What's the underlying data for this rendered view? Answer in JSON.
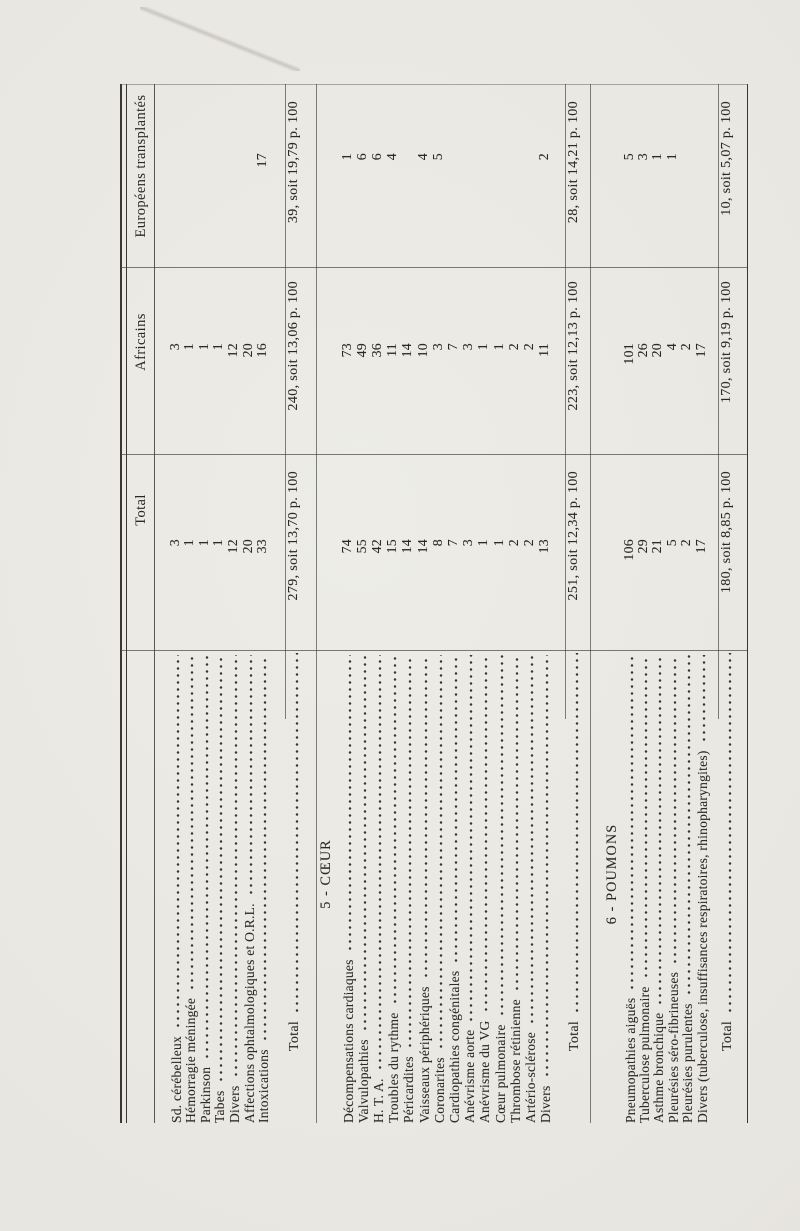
{
  "document": {
    "kind": "scanned statistical table page, rotated 90 degrees counter-clockwise",
    "language": "French"
  },
  "table": {
    "columns": {
      "total": "Total",
      "africains": "Africains",
      "europeens": "Européens transplantés"
    },
    "sections": [
      {
        "heading": "",
        "rows": [
          {
            "label": "Sd. cérébelleux",
            "total": "3",
            "africains": "3",
            "europeens": ""
          },
          {
            "label": "Hémorragie méningée",
            "total": "1",
            "africains": "1",
            "europeens": ""
          },
          {
            "label": "Parkinson",
            "total": "1",
            "africains": "1",
            "europeens": ""
          },
          {
            "label": "Tabes",
            "total": "1",
            "africains": "1",
            "europeens": ""
          },
          {
            "label": "Divers",
            "total": "12",
            "africains": "12",
            "europeens": ""
          },
          {
            "label": "Affections ophtalmologiques et O.R.L.",
            "total": "20",
            "africains": "20",
            "europeens": ""
          },
          {
            "label": "Intoxications",
            "total": "33",
            "africains": "16",
            "europeens": "17"
          }
        ],
        "total_row": {
          "label": "Total",
          "total": "279, soit 13,70 p. 100",
          "africains": "240, soit 13,06 p. 100",
          "europeens": "39, soit 19,79 p. 100"
        }
      },
      {
        "heading": "5 - CŒUR",
        "rows": [
          {
            "label": "Décompensations cardiaques",
            "total": "74",
            "africains": "73",
            "europeens": "1"
          },
          {
            "label": "Valvulopathies",
            "total": "55",
            "africains": "49",
            "europeens": "6"
          },
          {
            "label": "H. T. A.",
            "total": "42",
            "africains": "36",
            "europeens": "6"
          },
          {
            "label": "Troubles du rythme",
            "total": "15",
            "africains": "11",
            "europeens": "4"
          },
          {
            "label": "Péricardites",
            "total": "14",
            "africains": "14",
            "europeens": ""
          },
          {
            "label": "Vaisseaux périphériques",
            "total": "14",
            "africains": "10",
            "europeens": "4"
          },
          {
            "label": "Coronarites",
            "total": "8",
            "africains": "3",
            "europeens": "5"
          },
          {
            "label": "Cardiopathies congénitales",
            "total": "7",
            "africains": "7",
            "europeens": ""
          },
          {
            "label": "Anévrisme aorte",
            "total": "3",
            "africains": "3",
            "europeens": ""
          },
          {
            "label": "Anévrisme du VG",
            "total": "1",
            "africains": "1",
            "europeens": ""
          },
          {
            "label": "Cœur pulmonaire",
            "total": "1",
            "africains": "1",
            "europeens": ""
          },
          {
            "label": "Thrombose rétinienne",
            "total": "2",
            "africains": "2",
            "europeens": ""
          },
          {
            "label": "Artério-sclérose",
            "total": "2",
            "africains": "2",
            "europeens": ""
          },
          {
            "label": "Divers",
            "total": "13",
            "africains": "11",
            "europeens": "2"
          }
        ],
        "total_row": {
          "label": "Total",
          "total": "251, soit 12,34 p. 100",
          "africains": "223, soit 12,13 p. 100",
          "europeens": "28, soit 14,21 p. 100"
        }
      },
      {
        "heading": "6 - POUMONS",
        "rows": [
          {
            "label": "Pneumopathies aiguës",
            "total": "106",
            "africains": "101",
            "europeens": "5"
          },
          {
            "label": "Tuberculose pulmonaire",
            "total": "29",
            "africains": "26",
            "europeens": "3"
          },
          {
            "label": "Asthme bronchique",
            "total": "21",
            "africains": "20",
            "europeens": "1"
          },
          {
            "label": "Pleurésies séro-fibrineuses",
            "total": "5",
            "africains": "4",
            "europeens": "1"
          },
          {
            "label": "Pleurésies purulentes",
            "total": "2",
            "africains": "2",
            "europeens": ""
          },
          {
            "label": "Divers (tuberculose, insuffisances respiratoires, rhinopharyngites)",
            "total": "17",
            "africains": "17",
            "europeens": ""
          }
        ],
        "total_row": {
          "label": "Total",
          "total": "180, soit 8,85 p. 100",
          "africains": "170, soit 9,19 p. 100",
          "europeens": "10, soit 5,07 p. 100"
        }
      }
    ]
  }
}
